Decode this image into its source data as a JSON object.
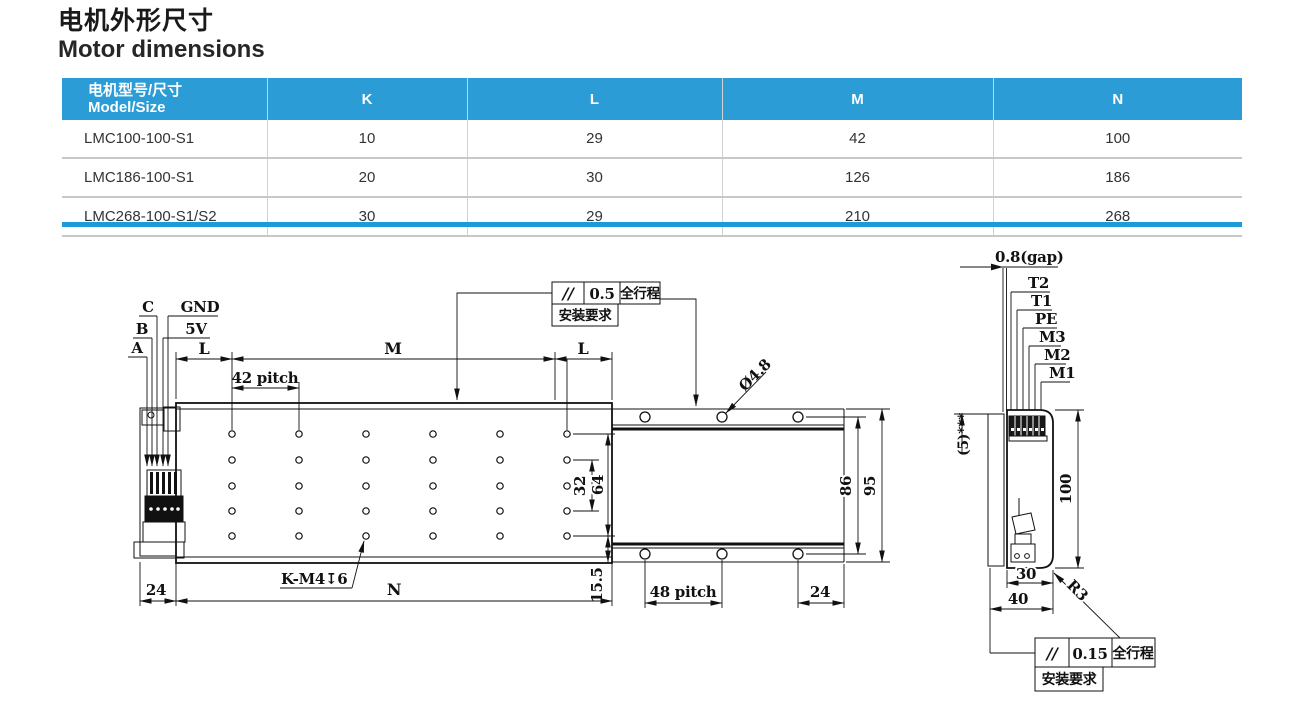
{
  "page": {
    "title_zh": "电机外形尺寸",
    "title_en": "Motor dimensions"
  },
  "table": {
    "header": {
      "model_line1": "电机型号/尺寸",
      "model_line2": "Model/Size",
      "k": "K",
      "l": "L",
      "m": "M",
      "n": "N"
    },
    "rows": [
      {
        "model": "LMC100-100-S1",
        "k": "10",
        "l": "29",
        "m": "42",
        "n": "100"
      },
      {
        "model": "LMC186-100-S1",
        "k": "20",
        "l": "30",
        "m": "126",
        "n": "186"
      },
      {
        "model": "LMC268-100-S1/S2",
        "k": "30",
        "l": "29",
        "m": "210",
        "n": "268"
      }
    ],
    "colors": {
      "header_bg": "#2b9cd6",
      "accent_bar": "#1d9bd8",
      "row_border": "#c8c8c8"
    }
  },
  "drawing": {
    "front": {
      "wire_a": "A",
      "wire_b": "B",
      "wire_c": "C",
      "wire_gnd": "GND",
      "wire_5v": "5V",
      "dim_l_left": "L",
      "dim_m": "M",
      "dim_l_right": "L",
      "dim_42_pitch": "42 pitch",
      "dim_32": "32",
      "dim_64": "64",
      "dim_15_5": "15.5",
      "dim_24_left": "24",
      "dim_n": "N",
      "thread_note": "K-M4↧6",
      "hole_dia": "Ø4.8",
      "dim_48_pitch": "48 pitch",
      "dim_24_right": "24",
      "dim_86": "86",
      "dim_95": "95"
    },
    "side": {
      "dim_gap": "0.8(gap)",
      "wire_t2": "T2",
      "wire_t1": "T1",
      "wire_pe": "PE",
      "wire_m3": "M3",
      "wire_m2": "M2",
      "wire_m1": "M1",
      "note_5": "(5)***",
      "dim_100": "100",
      "dim_30": "30",
      "dim_40": "40",
      "radius_r3": "R3"
    },
    "callout_top": {
      "symbol": "//",
      "value": "0.5",
      "range": "全行程",
      "note": "安装要求"
    },
    "callout_bottom": {
      "symbol": "//",
      "value": "0.15",
      "range": "全行程",
      "note": "安装要求"
    }
  }
}
